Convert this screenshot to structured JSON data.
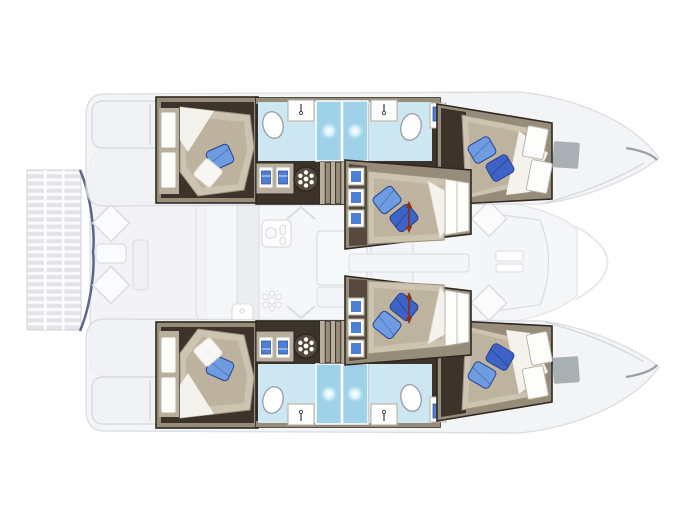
{
  "diagram": {
    "label": "Catamaran yacht floor plan, top view",
    "orientation": {
      "bow": "right",
      "stern_platform": "left"
    },
    "layers": {
      "solid": "hull accommodation layout",
      "faded": "main deck, salon and cockpit outline"
    },
    "counts": {
      "cabins": 6,
      "double_berths": 6,
      "toilets": 4,
      "sink_vanities": 6,
      "shower_spotlights": 4,
      "companionway_stairs": 2,
      "bow_deck_windows": 2
    },
    "rooms": {
      "port_hull": [
        "aft double cabin with wardrobe",
        "head with toilet and sink",
        "twin shower with spotlights",
        "head with toilet and sink",
        "forward double cabin",
        "angled bow double cabin with step shelves"
      ],
      "starboard_hull": [
        "aft double cabin with wardrobe",
        "head with toilet and sink",
        "twin shower with spotlights",
        "head with toilet and sink",
        "forward double cabin",
        "angled bow double cabin with step shelves"
      ],
      "center": [
        "stern tender platform with slats",
        "aft walkway with deck hatches",
        "salon with galley, stove, sink and table",
        "forward cockpit area"
      ]
    },
    "icons": [
      "toilet-icon",
      "sink-vanity-icon",
      "shower-spotlight-icon",
      "hatch-wheel-icon",
      "towel-shelf-icon",
      "stairs-icon",
      "stove-icon",
      "burner-icon",
      "galley-sink-icon",
      "deck-hatch-icon",
      "bow-window-icon",
      "trampoline-slats-icon",
      "height-arrow-icon"
    ]
  },
  "colors": {
    "floor": "#3c332a",
    "floor2": "#554a3d",
    "wall": "#978c79",
    "wall_light": "#b8ae9c",
    "outline": "#2e2822",
    "bed": "#ccc3b1",
    "bed_shade": "#b0a48e",
    "sheet": "#f4f2ed",
    "pillow_light": "#6f9ce0",
    "pillow_dark": "#3d63c6",
    "pillow_edge": "#2a4390",
    "towel": "#4d7fd6",
    "bath": "#cde7f2",
    "shower": "#9fd2e8",
    "navy": "#2e3a66",
    "window": "#9aa3a8",
    "arrow": "#8a3212",
    "faded_fill": "#f1f2f5",
    "faded_line": "#d2d5db",
    "white": "#ffffff"
  }
}
